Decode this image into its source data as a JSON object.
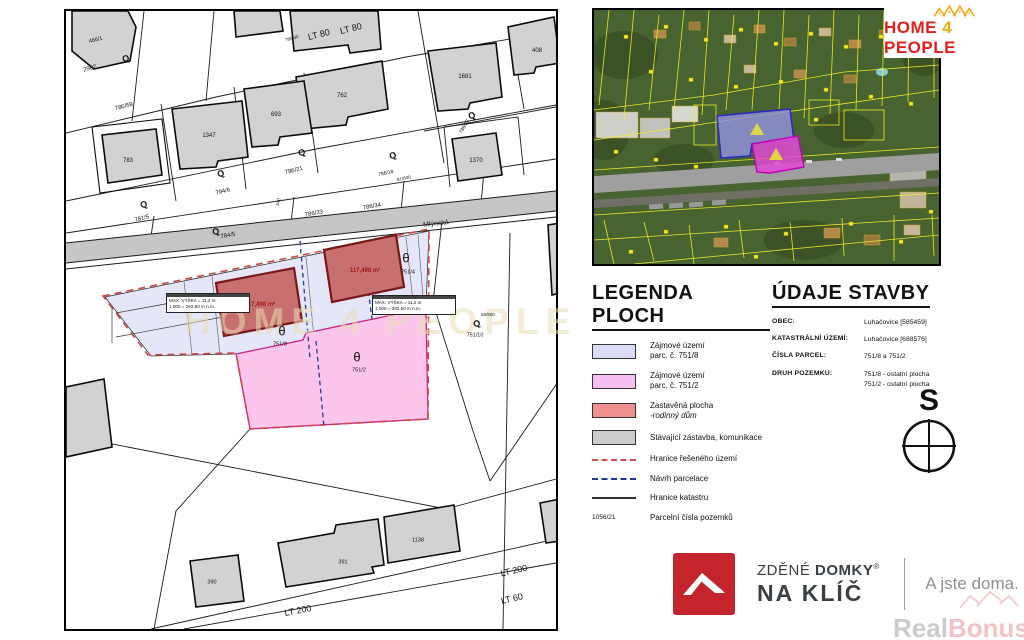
{
  "map": {
    "watermark": "HOME 4 PEOPLE",
    "annotation": {
      "line1": "MAX. VÝŠKA = 11,2 m",
      "line2": "1,000 = 292,50 m n.m."
    },
    "building_area_label": "117,498 m²",
    "labels": [
      {
        "t": "466/1",
        "x": 30,
        "y": 30,
        "r": -14,
        "s": 5.5
      },
      {
        "t": "2907",
        "x": 24,
        "y": 58,
        "r": -14,
        "s": 6
      },
      {
        "t": "786/59",
        "x": 58,
        "y": 96,
        "r": -14,
        "s": 6
      },
      {
        "t": "783",
        "x": 62,
        "y": 150,
        "s": 6
      },
      {
        "t": "1347",
        "x": 143,
        "y": 125,
        "s": 6
      },
      {
        "t": "693",
        "x": 210,
        "y": 104,
        "s": 6
      },
      {
        "t": "762",
        "x": 276,
        "y": 85,
        "s": 6
      },
      {
        "t": "1681",
        "x": 399,
        "y": 66,
        "s": 6
      },
      {
        "t": "408",
        "x": 471,
        "y": 40,
        "s": 6
      },
      {
        "t": "1370",
        "x": 410,
        "y": 150,
        "s": 6
      },
      {
        "t": "LT 80",
        "x": 253,
        "y": 24,
        "r": -14,
        "s": 9
      },
      {
        "t": "LT 80",
        "x": 285,
        "y": 18,
        "r": -14,
        "s": 9
      },
      {
        "t": "786/40",
        "x": 226,
        "y": 28,
        "r": -14,
        "s": 4.5
      },
      {
        "t": "786/21",
        "x": 228,
        "y": 160,
        "r": -14,
        "s": 6
      },
      {
        "t": "794/6",
        "x": 157,
        "y": 181,
        "r": -14,
        "s": 6
      },
      {
        "t": "781/5",
        "x": 76,
        "y": 208,
        "r": -14,
        "s": 6
      },
      {
        "t": "786/32",
        "x": 399,
        "y": 116,
        "r": -60,
        "s": 5
      },
      {
        "t": "786/18",
        "x": 320,
        "y": 163,
        "r": -12,
        "s": 5
      },
      {
        "t": "81/600",
        "x": 338,
        "y": 168,
        "r": -12,
        "s": 4.5
      },
      {
        "t": "786/33",
        "x": 248,
        "y": 203,
        "r": -10,
        "s": 6
      },
      {
        "t": "786/34",
        "x": 306,
        "y": 196,
        "r": -10,
        "s": 6
      },
      {
        "t": "Mlýnská",
        "x": 370,
        "y": 213,
        "r": -6,
        "s": 7,
        "c": "#222222"
      },
      {
        "t": "784/5",
        "x": 162,
        "y": 225,
        "r": -10,
        "s": 6
      },
      {
        "t": "640",
        "x": 213,
        "y": 191,
        "r": -75,
        "s": 4.5
      },
      {
        "t": "θ",
        "x": 340,
        "y": 247,
        "s": 13
      },
      {
        "t": "751/4",
        "x": 342,
        "y": 262,
        "s": 5.5
      },
      {
        "t": "θ",
        "x": 216,
        "y": 320,
        "s": 13
      },
      {
        "t": "751/8",
        "x": 214,
        "y": 334,
        "s": 5.5
      },
      {
        "t": "θ",
        "x": 291,
        "y": 346,
        "s": 13
      },
      {
        "t": "751/2",
        "x": 293,
        "y": 360,
        "s": 5.5
      },
      {
        "t": "60/600",
        "x": 422,
        "y": 304,
        "s": 4.5
      },
      {
        "t": "751/10",
        "x": 409,
        "y": 325,
        "s": 5.5
      },
      {
        "t": "390",
        "x": 146,
        "y": 572,
        "s": 5.5
      },
      {
        "t": "391",
        "x": 277,
        "y": 552,
        "s": 5.5
      },
      {
        "t": "1138",
        "x": 352,
        "y": 530,
        "s": 5.5
      },
      {
        "t": "LT 200",
        "x": 448,
        "y": 560,
        "r": -13,
        "s": 9
      },
      {
        "t": "LT 60",
        "x": 446,
        "y": 588,
        "r": -13,
        "s": 9
      },
      {
        "t": "LT 200",
        "x": 232,
        "y": 600,
        "r": -11,
        "s": 9
      },
      {
        "t": "117,498 m²",
        "x": 194,
        "y": 294,
        "s": 6,
        "c": "#a01818",
        "b": 1
      },
      {
        "t": "117,498 m²",
        "x": 299,
        "y": 260,
        "s": 6,
        "c": "#a01818",
        "b": 1
      }
    ],
    "symbols": [
      {
        "g": "Q",
        "x": 60,
        "y": 48
      },
      {
        "g": "Q",
        "x": 78,
        "y": 194
      },
      {
        "g": "Q",
        "x": 155,
        "y": 163
      },
      {
        "g": "Q",
        "x": 236,
        "y": 142
      },
      {
        "g": "Q",
        "x": 327,
        "y": 145
      },
      {
        "g": "Q",
        "x": 150,
        "y": 221
      },
      {
        "g": "Q",
        "x": 411,
        "y": 313
      },
      {
        "g": "Q",
        "x": 406,
        "y": 105
      }
    ]
  },
  "legend": {
    "title": "LEGENDA PLOCH",
    "items": [
      {
        "type": "swatch",
        "color": "#dcdcf6",
        "lines": [
          "Zájmové území",
          "parc. č. 751/8"
        ]
      },
      {
        "type": "swatch",
        "color": "#f6c0f2",
        "lines": [
          "Zájmové území",
          "parc. č. 751/2"
        ]
      },
      {
        "type": "swatch",
        "color": "#ef8f8f",
        "lines": [
          "Zastavěná plocha",
          "-rodinný dům"
        ],
        "italic": true
      },
      {
        "type": "swatch",
        "color": "#cccccc",
        "lines": [
          "Stávající zástavba, komunikace"
        ]
      },
      {
        "type": "line-red-dash",
        "lines": [
          "Hranice řešeného území"
        ]
      },
      {
        "type": "line-blue-dash",
        "lines": [
          "Návrh parcelace"
        ]
      },
      {
        "type": "line-solid",
        "lines": [
          "Hranice katastru"
        ]
      },
      {
        "type": "parcel-number",
        "sample": "1056/21",
        "lines": [
          "Parcelní čísla pozemků"
        ]
      }
    ]
  },
  "building_data": {
    "title": "ÚDAJE STAVBY",
    "rows": [
      {
        "label": "OBEC:",
        "values": [
          "Luhačovice [585459]"
        ]
      },
      {
        "label": "KATASTRÁLNÍ ÚZEMÍ:",
        "values": [
          "Luhačovice [688576]"
        ]
      },
      {
        "label": "ČÍSLA PARCEL:",
        "values": [
          "751/8 a 751/2"
        ]
      },
      {
        "label": "DRUH POZEMKU:",
        "values": [
          "751/8 - ostatní plocha",
          "751/2 - ostatní plocha"
        ]
      }
    ]
  },
  "compass": {
    "label": "S"
  },
  "logos": {
    "home4people": {
      "home": "HOME",
      "four": "4",
      "people": "PEOPLE"
    },
    "zdene_domky": {
      "word1": "ZDĚNÉ",
      "word2": "DOMKY",
      "reg": "®",
      "line2": "NA KLÍČ",
      "tagline": "A jste doma."
    },
    "realbonus": {
      "real": "Real",
      "bonus": "Bonus",
      "cz": ".cz"
    }
  },
  "colors": {
    "accent_red": "#c4242c",
    "gold": "#f0a816",
    "lavender": "#e4e4f8",
    "pink": "#fcc6ec",
    "building_red": "#c87070",
    "magenta_border": "#cc2288"
  }
}
